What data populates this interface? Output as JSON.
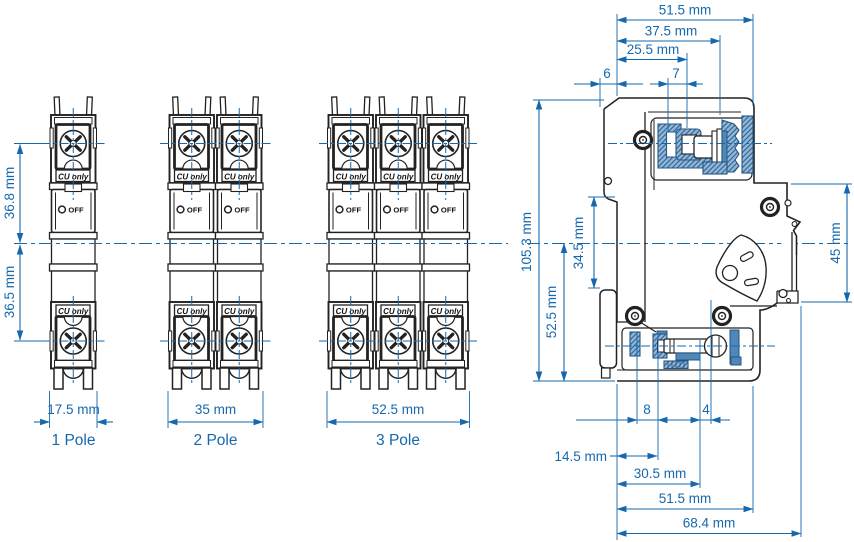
{
  "title": "Miniature circuit breaker dimensional drawing",
  "front": {
    "height_upper": "36.8 mm",
    "height_lower": "36.5 mm",
    "units": [
      {
        "label": "1 Pole",
        "width": "17.5 mm"
      },
      {
        "label": "2 Pole",
        "width": "35 mm"
      },
      {
        "label": "3 Pole",
        "width": "52.5 mm"
      }
    ],
    "cu_label": "CU only",
    "off_label": "OFF"
  },
  "side": {
    "top": {
      "d51": "51.5 mm",
      "d37": "37.5 mm",
      "d25": "25.5 mm",
      "d6": "6",
      "d7": "7"
    },
    "left": {
      "d105": "105.3 mm",
      "d34": "34.5 mm",
      "d52": "52.5 mm"
    },
    "right": {
      "d45": "45 mm"
    },
    "bottom": {
      "d8": "8",
      "d4": "4",
      "d14": "14.5 mm",
      "d30": "30.5 mm",
      "d51": "51.5 mm",
      "d68": "68.4 mm"
    }
  },
  "colors": {
    "dimension_blue": "#1668ae",
    "outline": "#222222",
    "section_fill_light": "#93b7d7",
    "section_fill_solid": "#4e87ba",
    "section_outline": "#27567f"
  }
}
